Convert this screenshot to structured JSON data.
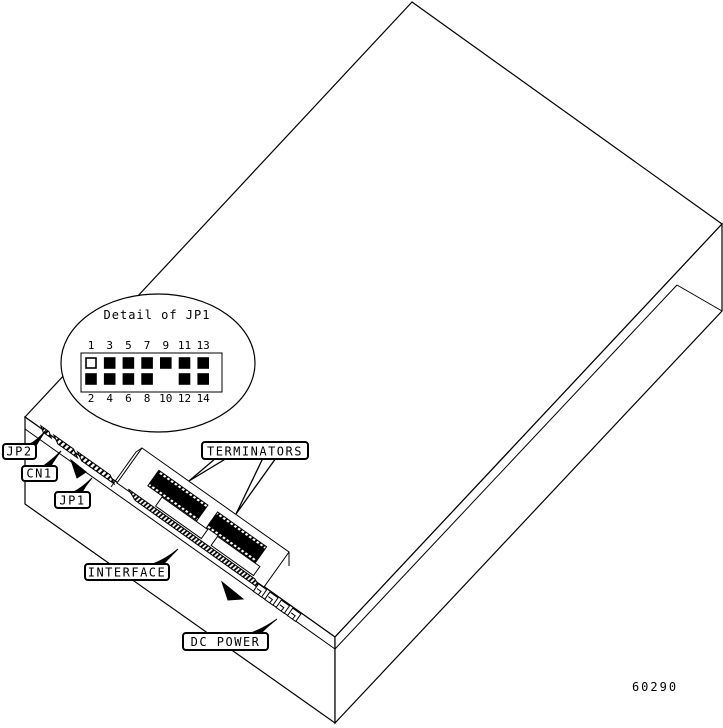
{
  "labels": {
    "jp2": "JP2",
    "cn1": "CN1",
    "jp1": "JP1",
    "terminators": "TERMINATORS",
    "interface": "INTERFACE",
    "dc_power": "DC POWER"
  },
  "detail_callout": {
    "title": "Detail of JP1",
    "top_pins": [
      {
        "n": "1",
        "state": "open"
      },
      {
        "n": "3",
        "state": "filled"
      },
      {
        "n": "5",
        "state": "filled"
      },
      {
        "n": "7",
        "state": "filled"
      },
      {
        "n": "9",
        "state": "filled"
      },
      {
        "n": "11",
        "state": "filled"
      },
      {
        "n": "13",
        "state": "filled"
      }
    ],
    "bottom_pins": [
      {
        "n": "2",
        "state": "filled"
      },
      {
        "n": "4",
        "state": "filled"
      },
      {
        "n": "6",
        "state": "filled"
      },
      {
        "n": "8",
        "state": "filled"
      },
      {
        "n": "10",
        "state": "absent"
      },
      {
        "n": "12",
        "state": "filled"
      },
      {
        "n": "14",
        "state": "filled"
      }
    ]
  },
  "figure_number": "60290",
  "colors": {
    "line": "#000000",
    "background": "#ffffff",
    "chip_fill": "#000000"
  }
}
